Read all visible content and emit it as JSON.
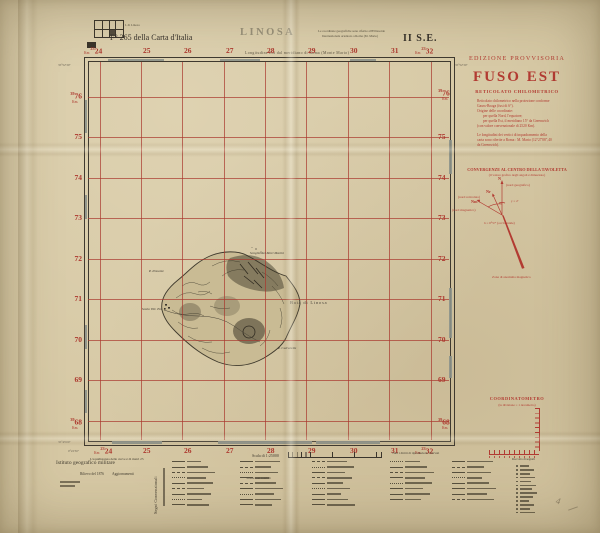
{
  "colors": {
    "grid_red": "#b23b32",
    "ink": "#3a352c",
    "paper": "#d6c8a4",
    "title_gray": "#8d8672"
  },
  "header": {
    "inset_label": "I. di Linosa",
    "sheet_ref": "F° 265 della Carta d'Italia",
    "title": "LINOSA",
    "note_line1": "Le coordinate geografiche sono riferite all'Ellissoide",
    "note_line2": "Internazionale orientato a Roma (M. Mario)",
    "quadrant": "II S.E."
  },
  "grid": {
    "unit": "Km",
    "unit_dot": "Km.",
    "top_axis_label": "Longitudine Est dal meridiano di Roma (Monte Mario)",
    "easting_prefix": "23",
    "northing_prefix": "39",
    "eastings": [
      "24",
      "25",
      "26",
      "27",
      "28",
      "29",
      "30",
      "31",
      "32"
    ],
    "northings": [
      "76",
      "75",
      "74",
      "73",
      "72",
      "71",
      "70",
      "69",
      "68"
    ],
    "corner_top_left_lat": "35°52'30\"",
    "corner_bottom_left_lat": "35°45'00\"",
    "corner_bottom_left_lon": "0°22'30\""
  },
  "map": {
    "labels": [
      {
        "text": "Scoglio dei Mori Marini"
      },
      {
        "text": "P. Ponente"
      },
      {
        "text": "Baia di Linosa"
      },
      {
        "text": "Scalo Vitt. Em."
      },
      {
        "text": "P. Calcarella"
      }
    ]
  },
  "panel": {
    "edition": "EDIZIONE PROVVISORIA",
    "fuso_title": "FUSO EST",
    "reticolato_title": "RETICOLATO CHILOMETRICO",
    "note1_lines": [
      "Reticolato chilometrico nella proiezione conforme",
      "Gauss-Boaga (fusi di 6°).",
      "Origine delle coordinate:",
      "per quella Nord, l'equatore;",
      "per quella Est, il meridiano 15° da Greenwich",
      "(con valore convenzionale di 2520 Km)."
    ],
    "note2_lines": [
      "Le longitudini dei vertici di inquadramento della",
      "carta sono riferite a Roma : M. Mario (12°27'08\",40",
      "da Greenwich)."
    ],
    "convergence_title": "CONVERGENZE AL CENTRO DELLA TAVOLETTA",
    "convergence_sub": "(il valore grafico degli angoli è dimezzato)",
    "diagram": {
      "n": "N",
      "n_sub": "(nord geografico)",
      "nr": "Nr",
      "nr_sub": "(nord reticolato)",
      "nm": "Nm",
      "nm_sub": "(nord magnetico)",
      "angle1": "γ = 2'",
      "angle2": "δ = 0°57' (occidentale)",
      "anomaly": "Zona di anomalia magnetica"
    },
    "coordinatometro_title": "COORDINATOMETRO",
    "coordinatometro_sub": "(la divisione = 1 decametro)"
  },
  "footer": {
    "institute": "Istituto geografico militare",
    "survey": "Rilievo del 1876",
    "updates": "Aggiornamenti",
    "conventional_signs": "Segni Convenzionali",
    "scale_label": "Scala di 1:25000",
    "equidistance_note": "L'equidistanza delle curve è di metri 25",
    "copyright": "Tutti i diritti di riproduzione riservati",
    "roads_header": "Strade non rotabili",
    "signals_header": "Raccolta di segnali",
    "pencil_note": "4"
  }
}
